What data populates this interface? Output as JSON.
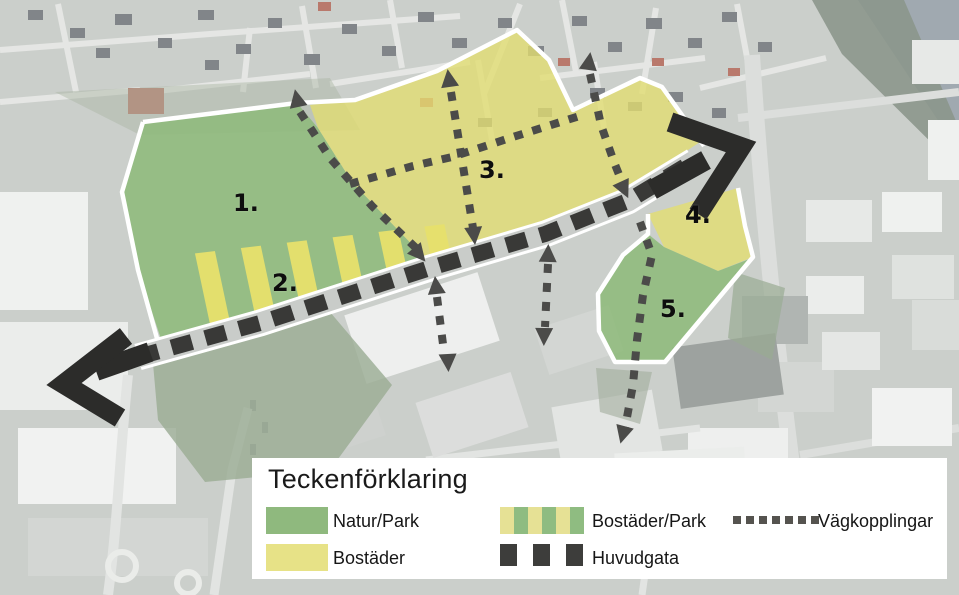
{
  "legend": {
    "title": "Teckenförklaring",
    "items": [
      {
        "id": "natur-park",
        "label": "Natur/Park",
        "swatch": "green-solid",
        "color": "#8fb97e"
      },
      {
        "id": "bostader",
        "label": "Bostäder",
        "swatch": "yellow-solid",
        "color": "#e7e287"
      },
      {
        "id": "bostader-park",
        "label": "Bostäder/Park",
        "swatch": "green-yellow-stripes",
        "colors": [
          "#e6e195",
          "#8fbc81"
        ]
      },
      {
        "id": "huvudgata",
        "label": "Huvudgata",
        "swatch": "dark-dash-squares",
        "color": "#3d3d3b"
      },
      {
        "id": "vagkopplingar",
        "label": "Vägkopplingar",
        "swatch": "small-dotted-line",
        "color": "#55534f"
      }
    ]
  },
  "map": {
    "zones": [
      {
        "id": "zone-1",
        "label": "1.",
        "type": "Natur/Park"
      },
      {
        "id": "zone-2",
        "label": "2.",
        "type": "Bostäder/Park"
      },
      {
        "id": "zone-3",
        "label": "3.",
        "type": "Bostäder"
      },
      {
        "id": "zone-4",
        "label": "4.",
        "type": "Bostäder"
      },
      {
        "id": "zone-5",
        "label": "5.",
        "type": "Natur/Park"
      }
    ]
  },
  "colors": {
    "zone_green": "#8fba7b",
    "zone_yellow": "#e2dd70",
    "stripe_yellow": "#e7e06b",
    "huvudgata_dash": "#393937",
    "vagkoppling_dash": "#4b4b49",
    "plan_boundary": "#ffffff",
    "arrow": "#2c2c2a",
    "legend_background": "#ffffff"
  }
}
